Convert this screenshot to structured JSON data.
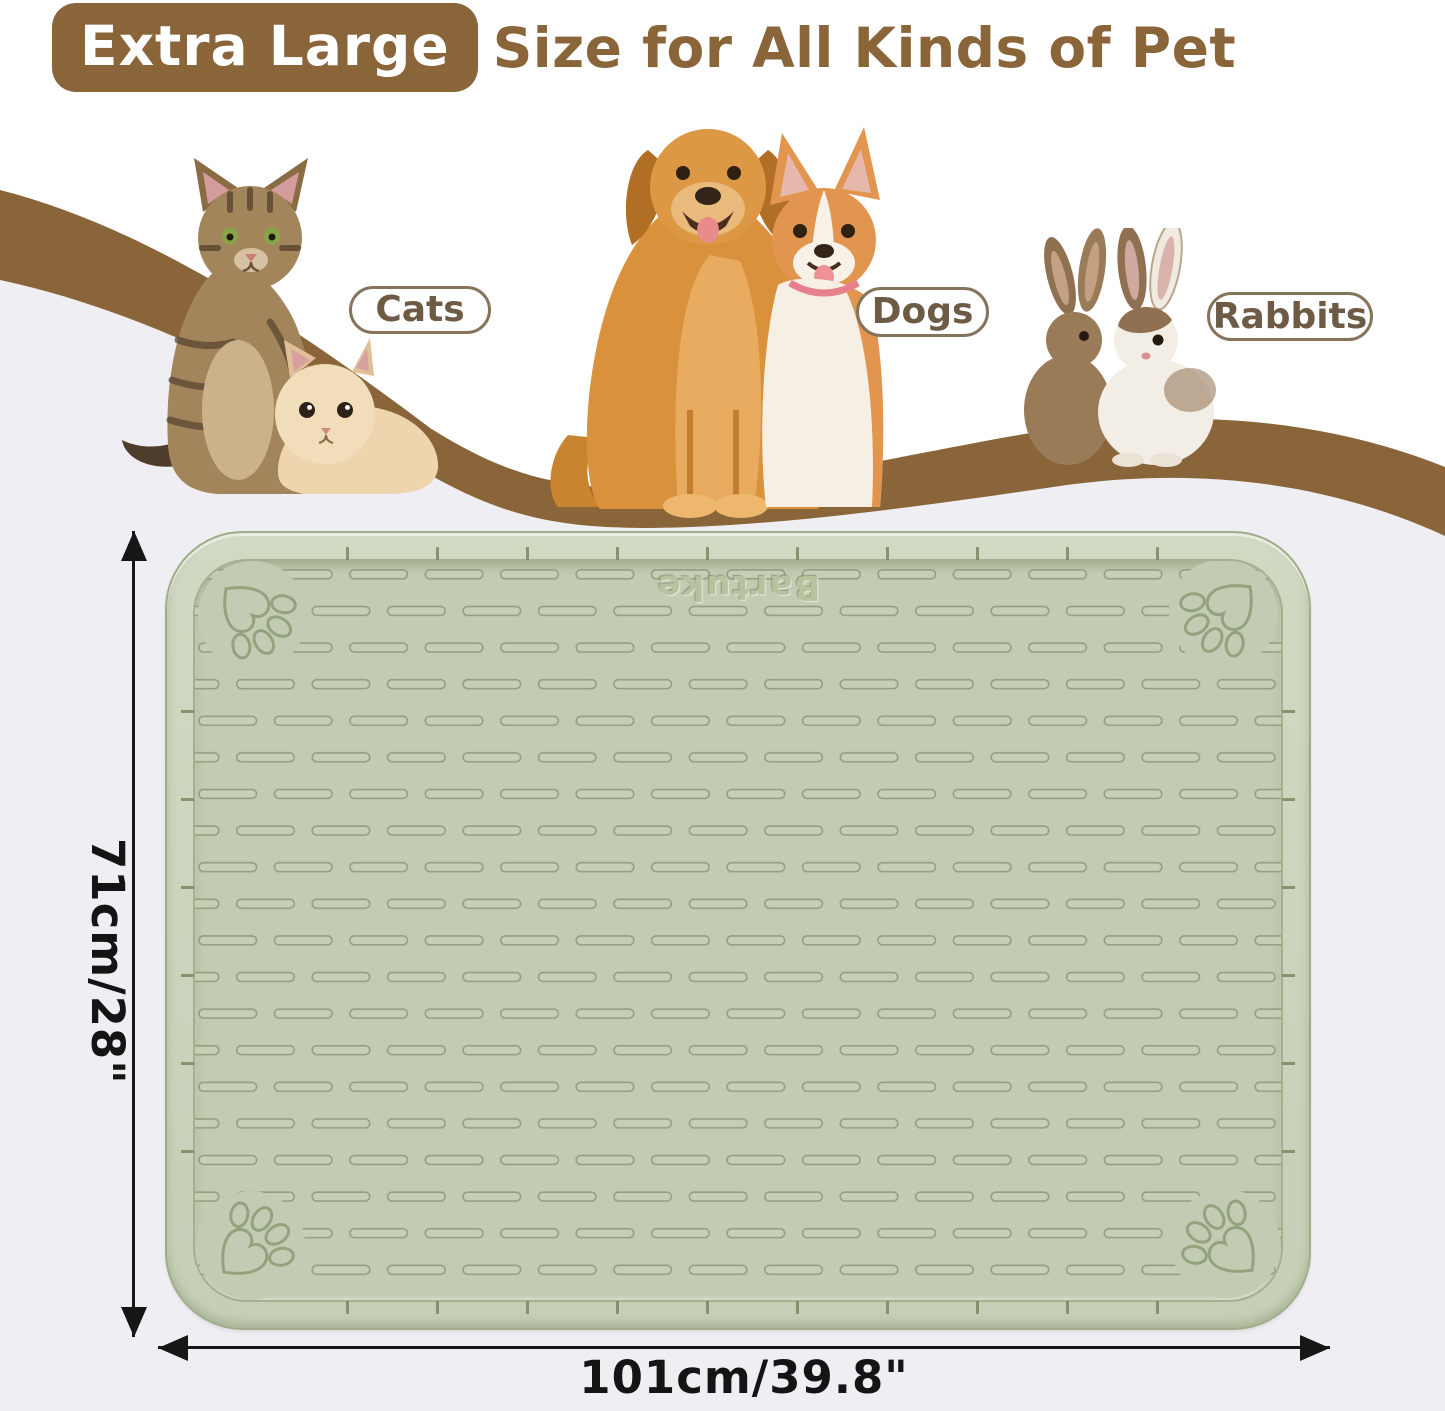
{
  "title": {
    "badge_label": "Extra Large",
    "heading_rest": "Size for All Kinds of Pet"
  },
  "labels": {
    "cats": "Cats",
    "dogs": "Dogs",
    "rabbits": "Rabbits"
  },
  "mat": {
    "brand": "Bartuke"
  },
  "dimensions": {
    "height": "71cm/28\"",
    "width": "101cm/39.8\""
  },
  "colors": {
    "brand_brown": "#8a6539",
    "pill_text_brown": "#6d5b45",
    "mat_green": "#c3ccb2",
    "mat_groove_green": "#8fa07d",
    "lower_background": "#efeef3",
    "dimension_text": "#141414"
  }
}
